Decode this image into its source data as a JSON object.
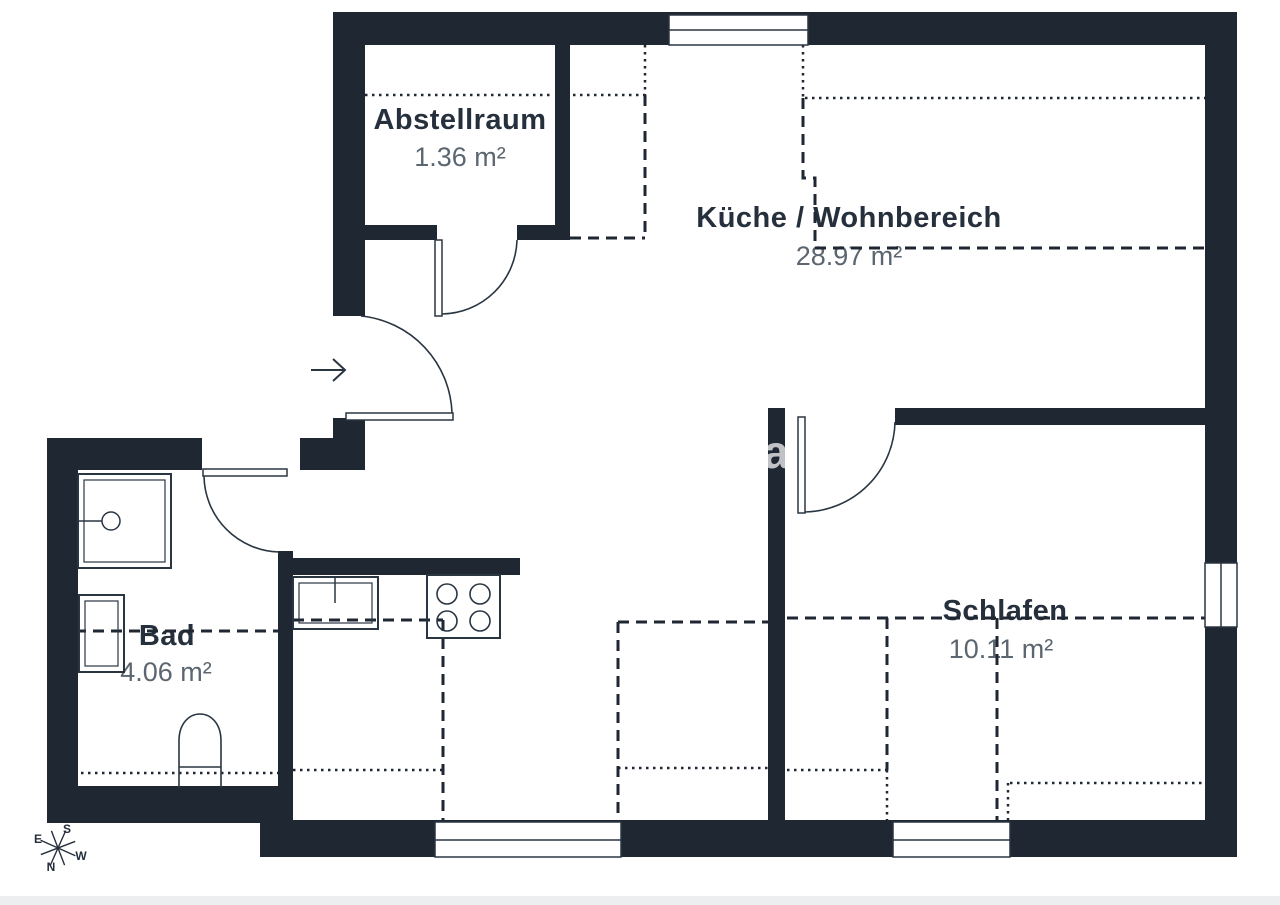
{
  "floorplan": {
    "rooms": [
      {
        "name": "Abstellraum",
        "area": "1.36 m²"
      },
      {
        "name": "Küche / Wohnbereich",
        "area": "28.97 m²"
      },
      {
        "name": "Bad",
        "area": "4.06 m²"
      },
      {
        "name": "Schlafen",
        "area": "10.11 m²"
      }
    ],
    "compass": {
      "north": "N",
      "south": "S",
      "east": "E",
      "west": "W"
    },
    "watermark": "a",
    "colors": {
      "wall": "#1F2733",
      "thin_line": "#2A3542",
      "room_name_text": "#26303D",
      "area_text": "#5C6670"
    }
  }
}
